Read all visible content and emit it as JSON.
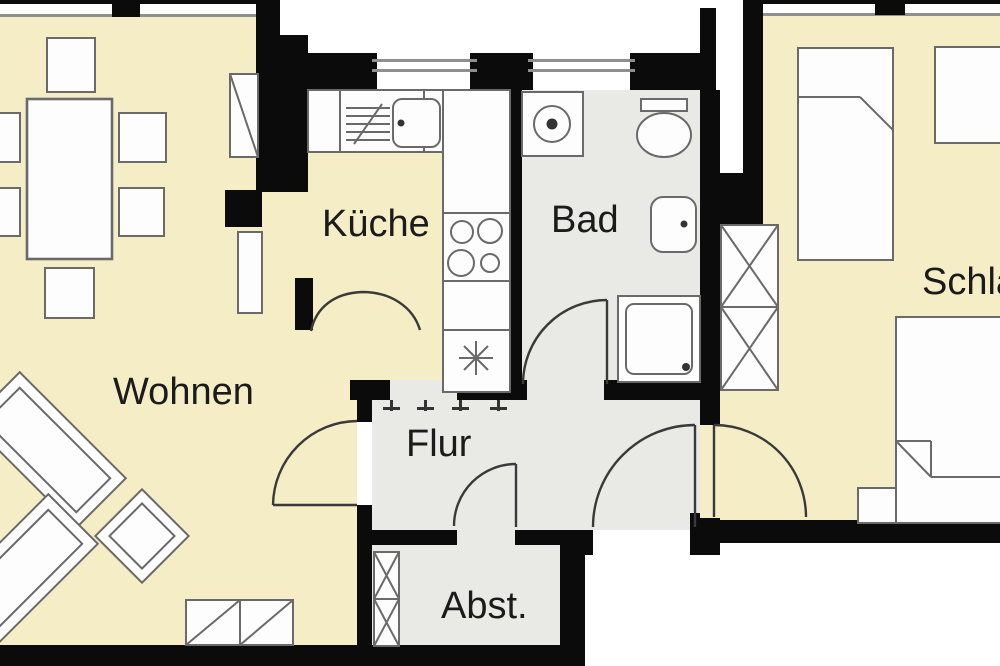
{
  "floorplan": {
    "type": "apartment-floor-plan",
    "rooms": [
      {
        "id": "wohnen",
        "label": "Wohnen"
      },
      {
        "id": "kueche",
        "label": "Küche"
      },
      {
        "id": "bad",
        "label": "Bad"
      },
      {
        "id": "flur",
        "label": "Flur"
      },
      {
        "id": "abst",
        "label": "Abst."
      },
      {
        "id": "schlafen",
        "label": "Schlafen"
      }
    ],
    "colors": {
      "background": "#ffffff",
      "wall": "#0b0b0b",
      "room_warm": "#f4edc6",
      "room_cool": "#e9e9e6",
      "furniture_fill": "#fdfdfd",
      "furniture_stroke": "#6a6a6a",
      "door_stroke": "#3a3a3a",
      "window_line": "#8f8f8f",
      "symbol_dark": "#333333",
      "label_color": "#1b1b1b"
    },
    "furniture": [
      {
        "name": "dining-table",
        "room": "wohnen"
      },
      {
        "name": "dining-chair",
        "room": "wohnen",
        "count": 6
      },
      {
        "name": "sofa",
        "room": "wohnen",
        "count": 2
      },
      {
        "name": "coffee-table",
        "room": "wohnen"
      },
      {
        "name": "sideboard",
        "room": "wohnen"
      },
      {
        "name": "cupboard",
        "room": "wohnen"
      },
      {
        "name": "radiator",
        "room": "wohnen"
      },
      {
        "name": "kitchen-counter",
        "room": "kueche"
      },
      {
        "name": "dishwasher",
        "room": "kueche"
      },
      {
        "name": "sink",
        "room": "kueche"
      },
      {
        "name": "stove",
        "room": "kueche"
      },
      {
        "name": "water-heater",
        "room": "kueche"
      },
      {
        "name": "washing-machine",
        "room": "bad"
      },
      {
        "name": "toilet",
        "room": "bad"
      },
      {
        "name": "washbasin",
        "room": "bad"
      },
      {
        "name": "shower",
        "room": "bad"
      },
      {
        "name": "broom-cupboard",
        "room": "abst"
      },
      {
        "name": "wardrobe",
        "room": "schlafen"
      },
      {
        "name": "single-bed",
        "room": "schlafen"
      },
      {
        "name": "double-bed",
        "room": "schlafen"
      },
      {
        "name": "nightstand",
        "room": "schlafen"
      },
      {
        "name": "desk",
        "room": "schlafen"
      }
    ]
  }
}
